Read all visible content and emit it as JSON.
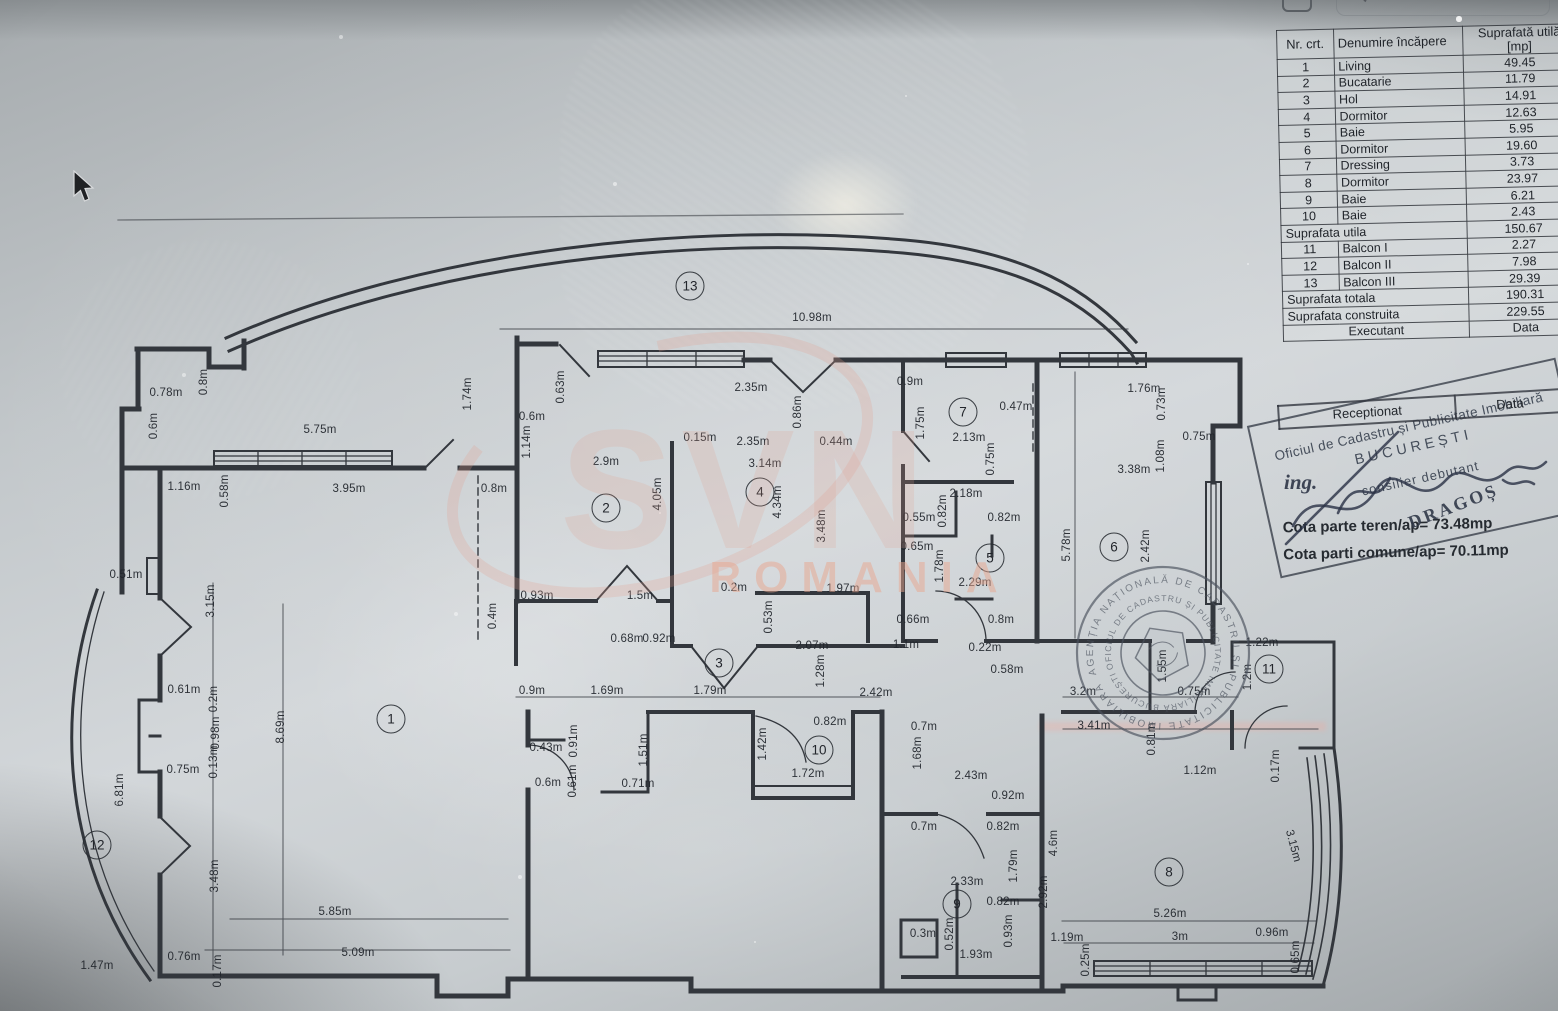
{
  "screen": {
    "search_label": "Search"
  },
  "room_table": {
    "headers": [
      "Nr. crt.",
      "Denumire încăpere",
      "Suprafată utilă [mp]"
    ],
    "rows": [
      {
        "nr": "1",
        "name": "Living",
        "area": "49.45"
      },
      {
        "nr": "2",
        "name": "Bucatarie",
        "area": "11.79"
      },
      {
        "nr": "3",
        "name": "Hol",
        "area": "14.91"
      },
      {
        "nr": "4",
        "name": "Dormitor",
        "area": "12.63"
      },
      {
        "nr": "5",
        "name": "Baie",
        "area": "5.95"
      },
      {
        "nr": "6",
        "name": "Dormitor",
        "area": "19.60"
      },
      {
        "nr": "7",
        "name": "Dressing",
        "area": "3.73"
      },
      {
        "nr": "8",
        "name": "Dormitor",
        "area": "23.97"
      },
      {
        "nr": "9",
        "name": "Baie",
        "area": "6.21"
      },
      {
        "nr": "10",
        "name": "Baie",
        "area": "2.43"
      },
      {
        "span": "Suprafata utila",
        "area": "150.67"
      },
      {
        "nr": "11",
        "name": "Balcon I",
        "area": "2.27"
      },
      {
        "nr": "12",
        "name": "Balcon II",
        "area": "7.98"
      },
      {
        "nr": "13",
        "name": "Balcon III",
        "area": "29.39"
      },
      {
        "span": "Suprafata totala",
        "area": "190.31"
      },
      {
        "span": "Suprafata construita",
        "area": "229.55"
      },
      {
        "exec": "Executant",
        "data": "Data"
      }
    ]
  },
  "reception": {
    "left": "Receptionat",
    "right": "Data"
  },
  "stamps": {
    "rect": {
      "line1": "Oficiul de Cadastru și Publicitate Imobiliară",
      "line2": "BUCUREȘTI",
      "line3": "consilier debutant",
      "sign_prefix": "ing.",
      "sign_name": "DRAGOȘ"
    },
    "round": {
      "outer": "AGENȚIA NAȚIONALĂ DE CADASTRU ȘI PUBLICITATE IMOBILIARĂ ✶",
      "inner": "OFICIUL DE CADASTRU ȘI PUBLICITATE IMOBILIARĂ BUCUREȘTI ✶"
    }
  },
  "notes": {
    "cota1": "Cota parte teren/ap= 73.48mp",
    "cota2": "Cota parti comune/ap= 70.11mp"
  },
  "watermark": {
    "logo": "SVN",
    "country": "ROMANIA"
  },
  "plan": {
    "rooms": [
      {
        "n": "1",
        "x": 391,
        "y": 719
      },
      {
        "n": "2",
        "x": 606,
        "y": 508
      },
      {
        "n": "3",
        "x": 719,
        "y": 663
      },
      {
        "n": "4",
        "x": 760,
        "y": 492
      },
      {
        "n": "5",
        "x": 990,
        "y": 558
      },
      {
        "n": "6",
        "x": 1114,
        "y": 547
      },
      {
        "n": "7",
        "x": 963,
        "y": 412
      },
      {
        "n": "8",
        "x": 1169,
        "y": 872
      },
      {
        "n": "9",
        "x": 957,
        "y": 904
      },
      {
        "n": "10",
        "x": 819,
        "y": 750
      },
      {
        "n": "11",
        "x": 1269,
        "y": 669
      },
      {
        "n": "12",
        "x": 97,
        "y": 845
      },
      {
        "n": "13",
        "x": 690,
        "y": 286
      }
    ],
    "dimensions": [
      {
        "t": "10.98m",
        "x": 812,
        "y": 318
      },
      {
        "t": "0.78m",
        "x": 166,
        "y": 393
      },
      {
        "t": "0.8m",
        "x": 204,
        "y": 382,
        "v": 1
      },
      {
        "t": "0.6m",
        "x": 154,
        "y": 426,
        "v": 1
      },
      {
        "t": "5.75m",
        "x": 320,
        "y": 430
      },
      {
        "t": "1.74m",
        "x": 468,
        "y": 394,
        "v": 1
      },
      {
        "t": "0.63m",
        "x": 561,
        "y": 387,
        "v": 1
      },
      {
        "t": "0.6m",
        "x": 532,
        "y": 417
      },
      {
        "t": "1.14m",
        "x": 527,
        "y": 442,
        "v": 1
      },
      {
        "t": "1.16m",
        "x": 184,
        "y": 487
      },
      {
        "t": "0.58m",
        "x": 225,
        "y": 491,
        "v": 1
      },
      {
        "t": "3.95m",
        "x": 349,
        "y": 489
      },
      {
        "t": "0.8m",
        "x": 494,
        "y": 489
      },
      {
        "t": "2.9m",
        "x": 606,
        "y": 462
      },
      {
        "t": "0.15m",
        "x": 700,
        "y": 438
      },
      {
        "t": "2.35m",
        "x": 753,
        "y": 442
      },
      {
        "t": "3.14m",
        "x": 765,
        "y": 464
      },
      {
        "t": "2.35m",
        "x": 751,
        "y": 388
      },
      {
        "t": "0.86m",
        "x": 798,
        "y": 412,
        "v": 1
      },
      {
        "t": "0.44m",
        "x": 836,
        "y": 442
      },
      {
        "t": "0.9m",
        "x": 910,
        "y": 382
      },
      {
        "t": "1.75m",
        "x": 921,
        "y": 423,
        "v": 1
      },
      {
        "t": "2.13m",
        "x": 969,
        "y": 438
      },
      {
        "t": "0.47m",
        "x": 1016,
        "y": 407
      },
      {
        "t": "0.75m",
        "x": 991,
        "y": 459,
        "v": 1
      },
      {
        "t": "1.76m",
        "x": 1144,
        "y": 389
      },
      {
        "t": "0.73m",
        "x": 1162,
        "y": 404,
        "v": 1
      },
      {
        "t": "0.75m",
        "x": 1199,
        "y": 437
      },
      {
        "t": "3.38m",
        "x": 1134,
        "y": 470
      },
      {
        "t": "1.08m",
        "x": 1161,
        "y": 456,
        "v": 1
      },
      {
        "t": "5.78m",
        "x": 1067,
        "y": 545,
        "v": 1
      },
      {
        "t": "2.42m",
        "x": 1146,
        "y": 546,
        "v": 1
      },
      {
        "t": "4.05m",
        "x": 658,
        "y": 494,
        "v": 1
      },
      {
        "t": "4.34m",
        "x": 778,
        "y": 502,
        "v": 1
      },
      {
        "t": "3.48m",
        "x": 822,
        "y": 526,
        "v": 1
      },
      {
        "t": "2.18m",
        "x": 966,
        "y": 494
      },
      {
        "t": "0.82m",
        "x": 943,
        "y": 511,
        "v": 1
      },
      {
        "t": "0.55m",
        "x": 919,
        "y": 518
      },
      {
        "t": "0.82m",
        "x": 1004,
        "y": 518
      },
      {
        "t": "0.65m",
        "x": 917,
        "y": 547
      },
      {
        "t": "1.78m",
        "x": 940,
        "y": 566,
        "v": 1
      },
      {
        "t": "2.29m",
        "x": 975,
        "y": 583
      },
      {
        "t": "0.66m",
        "x": 913,
        "y": 620
      },
      {
        "t": "0.8m",
        "x": 1001,
        "y": 620
      },
      {
        "t": "0.93m",
        "x": 537,
        "y": 596
      },
      {
        "t": "1.5m",
        "x": 640,
        "y": 596
      },
      {
        "t": "0.2m",
        "x": 734,
        "y": 588
      },
      {
        "t": "1.97m",
        "x": 843,
        "y": 589
      },
      {
        "t": "0.4m",
        "x": 493,
        "y": 616,
        "v": 1
      },
      {
        "t": "0.53m",
        "x": 769,
        "y": 617,
        "v": 1
      },
      {
        "t": "0.68m",
        "x": 627,
        "y": 639
      },
      {
        "t": "0.92m",
        "x": 659,
        "y": 639
      },
      {
        "t": "2.07m",
        "x": 812,
        "y": 646
      },
      {
        "t": "1.1m",
        "x": 906,
        "y": 645
      },
      {
        "t": "1.28m",
        "x": 821,
        "y": 671,
        "v": 1
      },
      {
        "t": "0.22m",
        "x": 985,
        "y": 648
      },
      {
        "t": "0.58m",
        "x": 1007,
        "y": 670
      },
      {
        "t": "0.9m",
        "x": 532,
        "y": 691
      },
      {
        "t": "1.69m",
        "x": 607,
        "y": 691
      },
      {
        "t": "1.79m",
        "x": 710,
        "y": 691
      },
      {
        "t": "2.42m",
        "x": 876,
        "y": 693
      },
      {
        "t": "3.2m",
        "x": 1083,
        "y": 692
      },
      {
        "t": "1.55m",
        "x": 1163,
        "y": 666,
        "v": 1
      },
      {
        "t": "0.75m",
        "x": 1194,
        "y": 692
      },
      {
        "t": "1.22m",
        "x": 1262,
        "y": 643
      },
      {
        "t": "1.2m",
        "x": 1248,
        "y": 677,
        "v": 1
      },
      {
        "t": "3.41m",
        "x": 1094,
        "y": 726
      },
      {
        "t": "0.81m",
        "x": 1152,
        "y": 739,
        "v": 1
      },
      {
        "t": "1.12m",
        "x": 1200,
        "y": 771
      },
      {
        "t": "0.17m",
        "x": 1276,
        "y": 766,
        "v": 1
      },
      {
        "t": "3.15m",
        "x": 1293,
        "y": 846,
        "r": 75
      },
      {
        "t": "4.6m",
        "x": 1054,
        "y": 843,
        "v": 1
      },
      {
        "t": "2.92m",
        "x": 1044,
        "y": 892,
        "v": 1
      },
      {
        "t": "5.26m",
        "x": 1170,
        "y": 914
      },
      {
        "t": "1.19m",
        "x": 1067,
        "y": 938
      },
      {
        "t": "3m",
        "x": 1180,
        "y": 937
      },
      {
        "t": "0.96m",
        "x": 1272,
        "y": 933
      },
      {
        "t": "0.25m",
        "x": 1086,
        "y": 960,
        "v": 1
      },
      {
        "t": "0.65m",
        "x": 1296,
        "y": 957,
        "v": 1
      },
      {
        "t": "0.51m",
        "x": 126,
        "y": 575
      },
      {
        "t": "3.15m",
        "x": 211,
        "y": 601,
        "v": 1
      },
      {
        "t": "0.61m",
        "x": 184,
        "y": 690
      },
      {
        "t": "0.2m",
        "x": 214,
        "y": 699,
        "v": 1
      },
      {
        "t": "0.98m",
        "x": 216,
        "y": 733,
        "v": 1
      },
      {
        "t": "0.13m",
        "x": 214,
        "y": 762,
        "v": 1
      },
      {
        "t": "0.75m",
        "x": 183,
        "y": 770
      },
      {
        "t": "6.81m",
        "x": 120,
        "y": 790,
        "v": 1
      },
      {
        "t": "8.69m",
        "x": 281,
        "y": 727,
        "v": 1
      },
      {
        "t": "3.48m",
        "x": 215,
        "y": 876,
        "v": 1
      },
      {
        "t": "5.85m",
        "x": 335,
        "y": 912
      },
      {
        "t": "0.76m",
        "x": 184,
        "y": 957
      },
      {
        "t": "5.09m",
        "x": 358,
        "y": 953
      },
      {
        "t": "0.17m",
        "x": 218,
        "y": 971,
        "v": 1
      },
      {
        "t": "1.47m",
        "x": 97,
        "y": 966
      },
      {
        "t": "0.43m",
        "x": 546,
        "y": 748
      },
      {
        "t": "0.91m",
        "x": 574,
        "y": 741,
        "v": 1
      },
      {
        "t": "0.61m",
        "x": 573,
        "y": 781,
        "v": 1
      },
      {
        "t": "0.6m",
        "x": 548,
        "y": 783
      },
      {
        "t": "1.51m",
        "x": 644,
        "y": 750,
        "v": 1
      },
      {
        "t": "0.71m",
        "x": 638,
        "y": 784
      },
      {
        "t": "1.42m",
        "x": 763,
        "y": 744,
        "v": 1
      },
      {
        "t": "0.82m",
        "x": 830,
        "y": 722
      },
      {
        "t": "1.72m",
        "x": 808,
        "y": 774
      },
      {
        "t": "0.7m",
        "x": 924,
        "y": 727
      },
      {
        "t": "1.68m",
        "x": 918,
        "y": 753,
        "v": 1
      },
      {
        "t": "2.43m",
        "x": 971,
        "y": 776
      },
      {
        "t": "0.92m",
        "x": 1008,
        "y": 796
      },
      {
        "t": "0.7m",
        "x": 924,
        "y": 827
      },
      {
        "t": "0.82m",
        "x": 1003,
        "y": 827
      },
      {
        "t": "1.79m",
        "x": 1014,
        "y": 866,
        "v": 1
      },
      {
        "t": "2.33m",
        "x": 967,
        "y": 882
      },
      {
        "t": "0.82m",
        "x": 1003,
        "y": 902
      },
      {
        "t": "0.3m",
        "x": 923,
        "y": 934
      },
      {
        "t": "0.52m",
        "x": 950,
        "y": 934,
        "v": 1
      },
      {
        "t": "0.93m",
        "x": 1009,
        "y": 931,
        "v": 1
      },
      {
        "t": "1.93m",
        "x": 976,
        "y": 955
      }
    ]
  }
}
